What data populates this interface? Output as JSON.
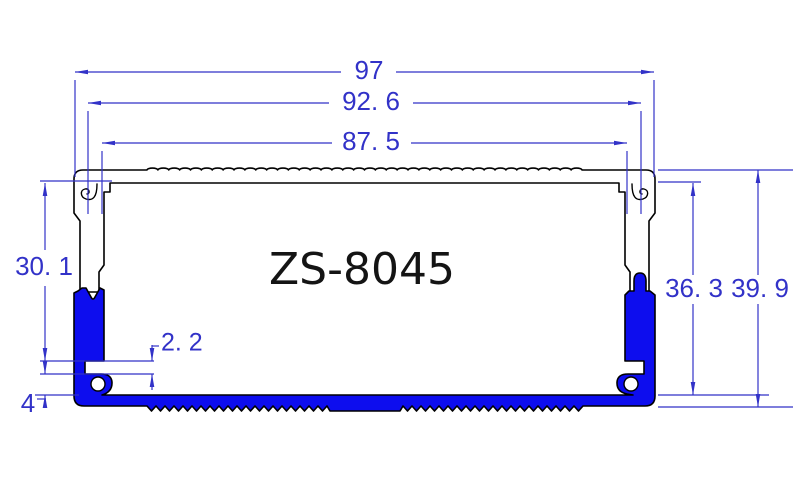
{
  "drawing": {
    "title": "ZS-8045",
    "dims": {
      "overall_width": "97",
      "hook_width": "92. 6",
      "inner_width": "87. 5",
      "left_height": "30. 1",
      "slot_height": "2. 2",
      "base_height": "4",
      "inner_height": "36. 3",
      "overall_height": "39. 9"
    },
    "colors": {
      "dimension_blue": "#3232c8",
      "profile_fill_blue": "#0d0dee",
      "outline_black": "#000000",
      "background": "#ffffff"
    }
  }
}
